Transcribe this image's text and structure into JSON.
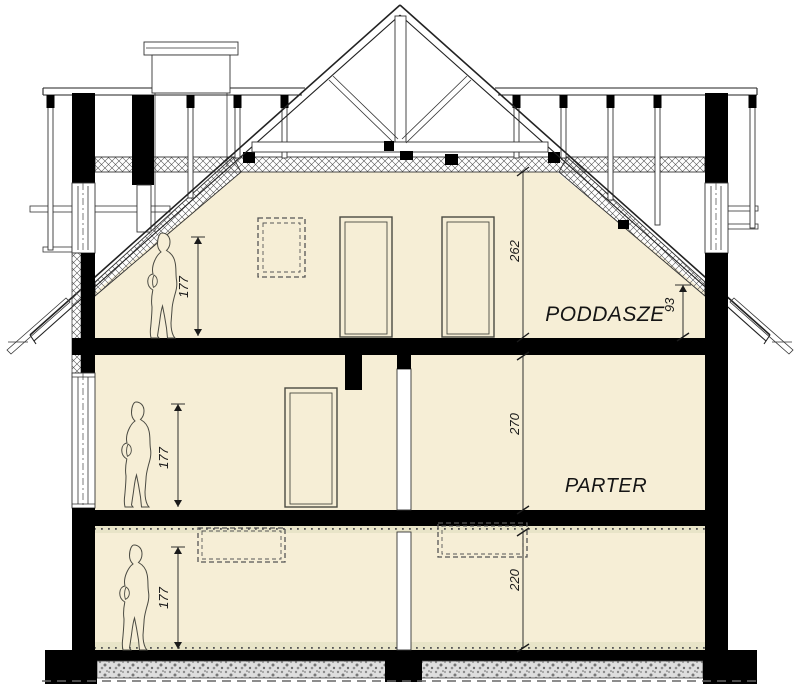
{
  "drawing": {
    "labels": {
      "attic": "PODDASZE",
      "ground_floor": "PARTER"
    },
    "dimensions": {
      "attic_ceiling_height": "262",
      "attic_knee_wall": "93",
      "ground_floor_height": "270",
      "basement_height": "220",
      "person_attic": "177",
      "person_ground": "177",
      "person_basement": "177"
    },
    "colors": {
      "room_fill": "#f6eed6",
      "line": "#222222",
      "cut_elements": "#000000",
      "insulation_band": "#e8e4c8",
      "gravel": "#dddddd"
    }
  }
}
